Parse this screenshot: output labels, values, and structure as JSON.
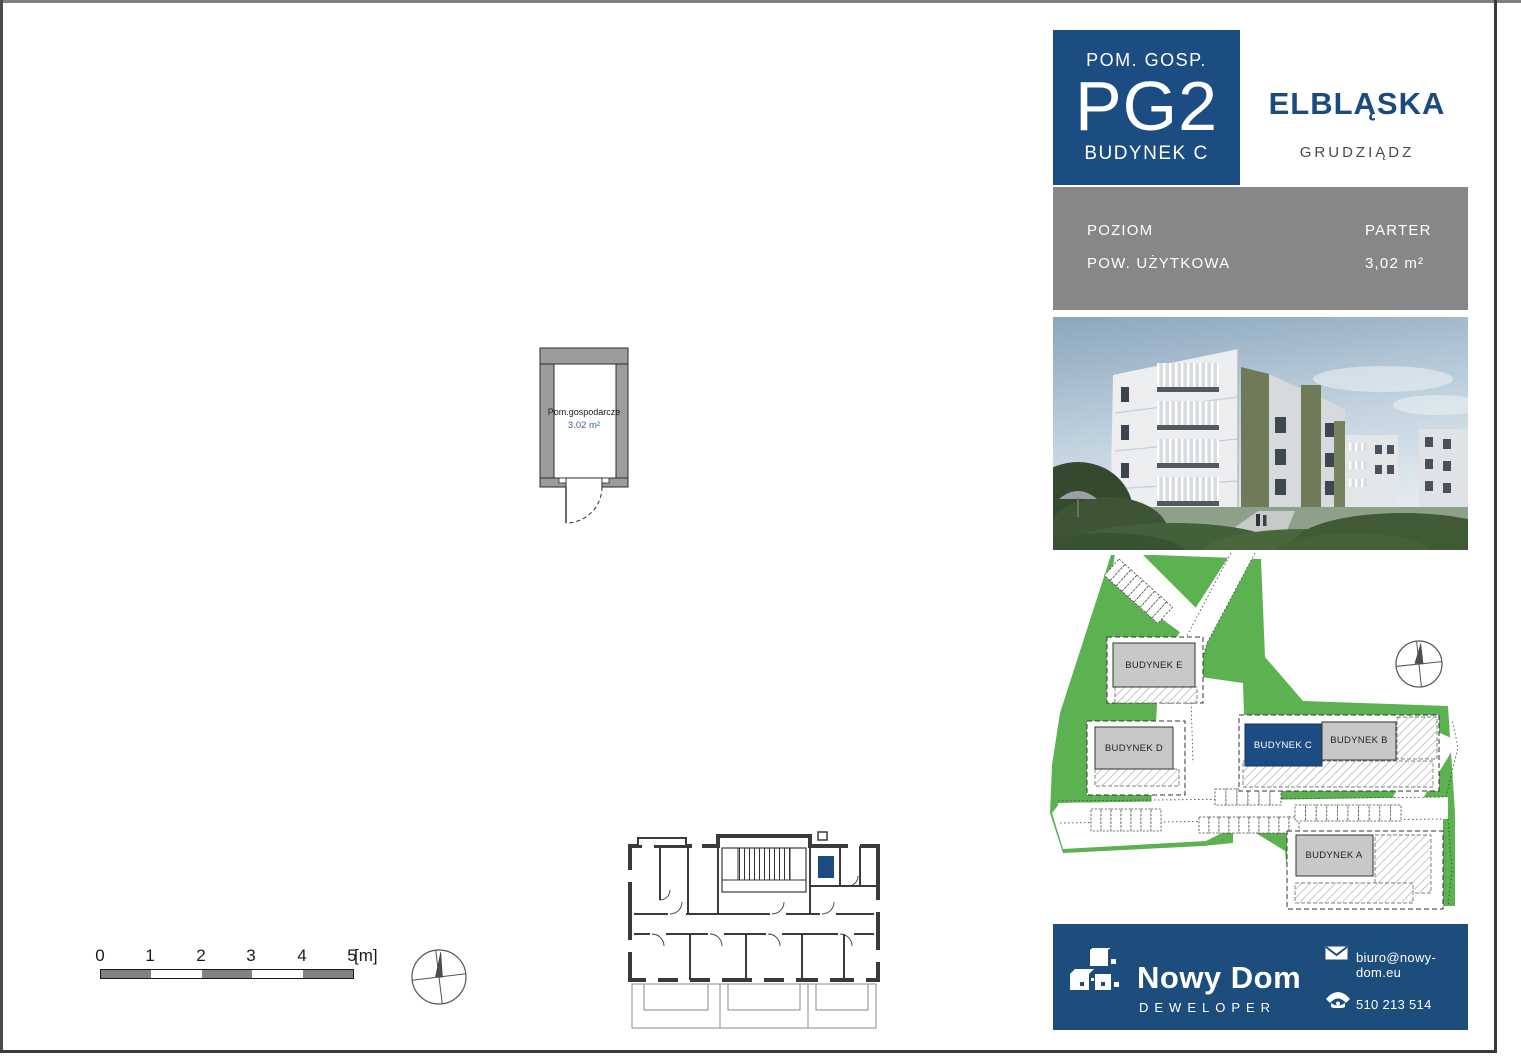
{
  "header": {
    "category": "POM. GOSP.",
    "unit_id": "PG2",
    "building": "BUDYNEK C",
    "project": "ELBLĄSKA",
    "city": "GRUDZIĄDZ"
  },
  "details": {
    "rows": [
      {
        "label": "POZIOM",
        "value": "PARTER"
      },
      {
        "label": "POW. UŻYTKOWA",
        "value": "3,02 m²"
      }
    ]
  },
  "unit_plan": {
    "room_label": "Pom.gospodarcze",
    "room_area": "3.02 m²"
  },
  "site_plan": {
    "buildings": [
      {
        "name": "BUDYNEK E",
        "highlighted": false
      },
      {
        "name": "BUDYNEK D",
        "highlighted": false
      },
      {
        "name": "BUDYNEK C",
        "highlighted": true
      },
      {
        "name": "BUDYNEK B",
        "highlighted": false
      },
      {
        "name": "BUDYNEK A",
        "highlighted": false
      }
    ]
  },
  "scale_bar": {
    "ticks": [
      "0",
      "1",
      "2",
      "3",
      "4",
      "5"
    ],
    "unit": "[m]"
  },
  "footer": {
    "company": "Nowy Dom",
    "role": "DEWELOPER",
    "email": "biuro@nowy-dom.eu",
    "phone": "510 213 514"
  },
  "colors": {
    "accent_blue": "#1c4d82",
    "footer_blue": "#1d4d7c",
    "title_blue": "#1b4a7e",
    "info_gray": "#878787",
    "plan_wall_gray": "#9c9c9c",
    "site_green": "#5cb150",
    "building_gray": "#c8c8c8",
    "area_text_blue": "#36649c"
  }
}
